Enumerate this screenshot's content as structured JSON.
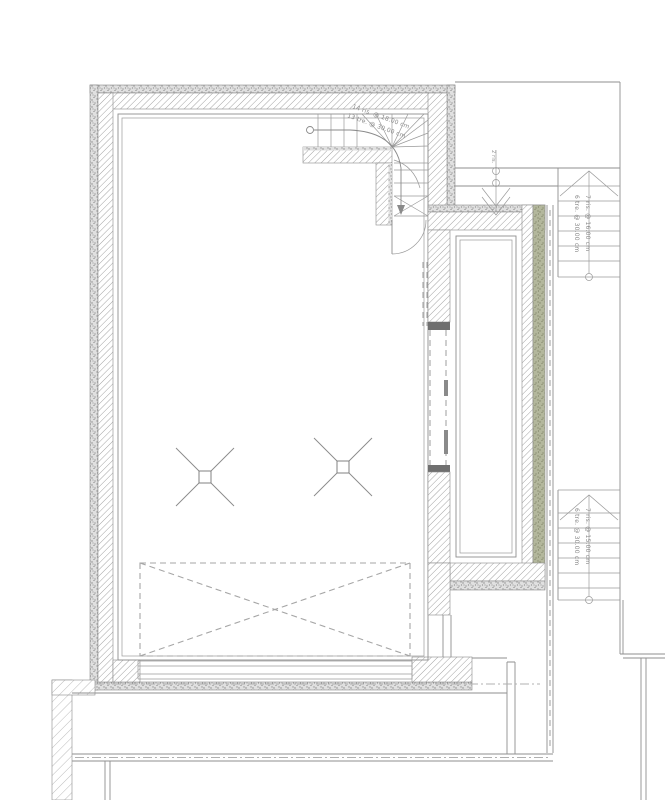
{
  "annotations": {
    "winder_stair": {
      "line1": "14 ris. @ 18.00 cm",
      "line2": "13 tre. @ 30.00 cm"
    },
    "upper_flight": {
      "risers": "7 ris. @ 16.00 cm",
      "treads": "6 tre. @ 30.00 cm"
    },
    "lower_flight": {
      "risers": "7 ris. @ 15.00 cm",
      "treads": "6 tre. @ 30.00 cm"
    },
    "entry_steps": {
      "label": "2 ris."
    }
  },
  "colors": {
    "background": "#ffffff",
    "line": "#8f8f8f",
    "hatch_line": "#a3a3a3",
    "stipple_dot": "#9a9a9a",
    "dark_jamb": "#6f6f6f",
    "insulation_band": "#b3b79c",
    "annotation_text": "#8a8a8a"
  }
}
